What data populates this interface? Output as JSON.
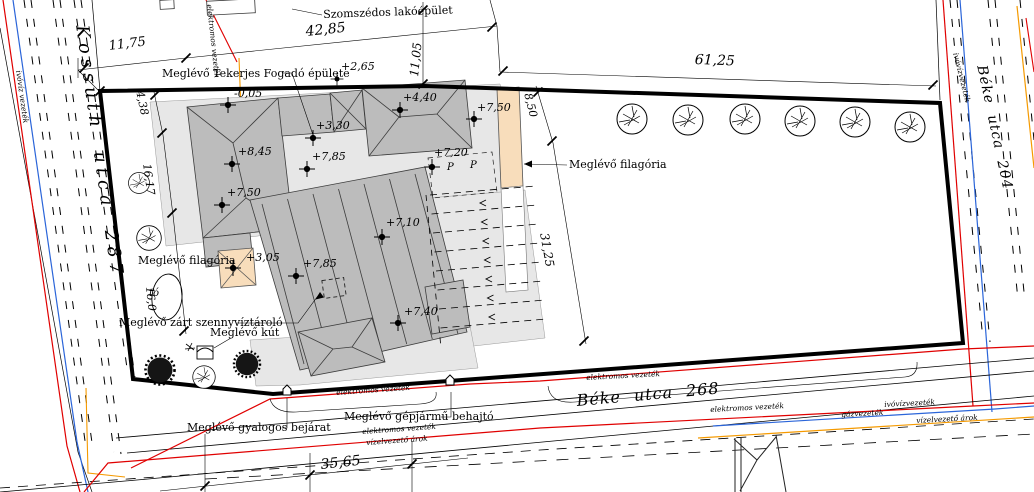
{
  "streets": {
    "left": {
      "name": "Kossuth utca  287"
    },
    "right": {
      "name": "Béke utca  204"
    },
    "bottom": {
      "name": "Béke utca  268"
    }
  },
  "site_labels": {
    "neighbor_building": "Szomszédos lakóépület",
    "inn_building": "Meglévő Tekerjes Fogadó épülete",
    "pergola_main": "Meglévő filagória",
    "pergola_garden": "Meglévő filagória",
    "sewage_tank": "Meglévő zárt szennyvíztároló",
    "well": "Meglévő kút",
    "pedestrian_entrance": "Meglévő gyalogos bejárat",
    "vehicle_entrance": "Meglévő gépjármű behajtó",
    "pond": "tó",
    "parking_letter": "P"
  },
  "elevation_points": [
    {
      "value": "-0,05"
    },
    {
      "value": "+3,30"
    },
    {
      "value": "+8,45"
    },
    {
      "value": "+7,85"
    },
    {
      "value": "+7,50"
    },
    {
      "value": "+4,40"
    },
    {
      "value": "+7,50"
    },
    {
      "value": "+7,20"
    },
    {
      "value": "+7,10"
    },
    {
      "value": "+3,05"
    },
    {
      "value": "+7,85"
    },
    {
      "value": "+7,40"
    },
    {
      "value": "+2,65"
    }
  ],
  "dimensions": [
    {
      "value": "11,75"
    },
    {
      "value": "42,85"
    },
    {
      "value": "11,05"
    },
    {
      "value": "61,25"
    },
    {
      "value": "8,50"
    },
    {
      "value": "31,25"
    },
    {
      "value": "4,38"
    },
    {
      "value": "16,17"
    },
    {
      "value": "16,0"
    },
    {
      "value": "35,65"
    }
  ],
  "utility_lines": {
    "electric": "elektromos vezeték",
    "drinking_water": "ivóvízvezeték",
    "drinking_water_spaced": "ivóvíz vezeték",
    "gas": "gázvezeték",
    "drain_ditch": "vízelvezető árok"
  },
  "colors": {
    "electric_line": "#e00000",
    "water_line": "#2b65d9",
    "gas_line": "#f59a00",
    "boundary": "#000000",
    "building_fill": "#bcbcbc",
    "paved_fill": "#e7e7e7",
    "pergola_fill": "#f8ddbb"
  }
}
